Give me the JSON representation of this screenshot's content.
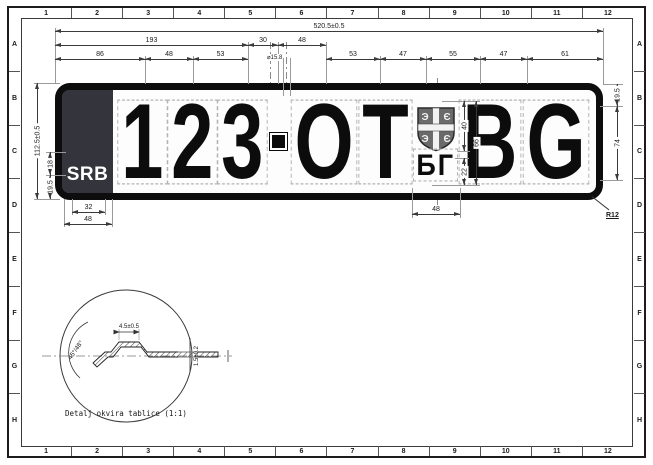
{
  "sheet": {
    "grid_cols": [
      "1",
      "2",
      "3",
      "4",
      "5",
      "6",
      "7",
      "8",
      "9",
      "10",
      "11",
      "12"
    ],
    "grid_rows": [
      "A",
      "B",
      "C",
      "D",
      "E",
      "F",
      "G",
      "H"
    ]
  },
  "plate": {
    "country": "SRB",
    "digits_chars": [
      "1",
      "2",
      "3"
    ],
    "letters1_chars": [
      "O",
      "T"
    ],
    "letters2_chars": [
      "B",
      "G"
    ],
    "city": "БГ",
    "shield_glyphs": [
      "Э",
      "Є",
      "Э",
      "Є"
    ]
  },
  "dims": {
    "total_width": "520.5±0.5",
    "seg_193": "193",
    "seg_30": "30",
    "seg_48_top": "48",
    "seg_86": "86",
    "seg_48_left": "48",
    "seg_53_left": "53",
    "hole": "⌀15.8",
    "seg_53_right": "53",
    "seg_47_a": "47",
    "seg_55": "55",
    "seg_47_b": "47",
    "seg_61": "61",
    "plate_height": "112.5±0.5",
    "srb_height": "18",
    "srb_margin": "19.5",
    "srb_width_inner": "32",
    "srb_width": "48",
    "char_margin_top": "19.5",
    "char_height": "74",
    "corner_radius": "R12",
    "shield_height": "40",
    "emblem_height": "66",
    "city_height": "22",
    "emblem_width": "48"
  },
  "detail": {
    "caption": "Detalj okvira tablice (1:1)",
    "angle": "45°/48°",
    "rib_width": "4.5±0.5",
    "thickness": "1.5±0.2"
  },
  "colors": {
    "line": "#3a3a3a",
    "plate_border": "#0d0d0d",
    "country_band": "#34353c",
    "shield_fill": "#6a6a6a"
  }
}
